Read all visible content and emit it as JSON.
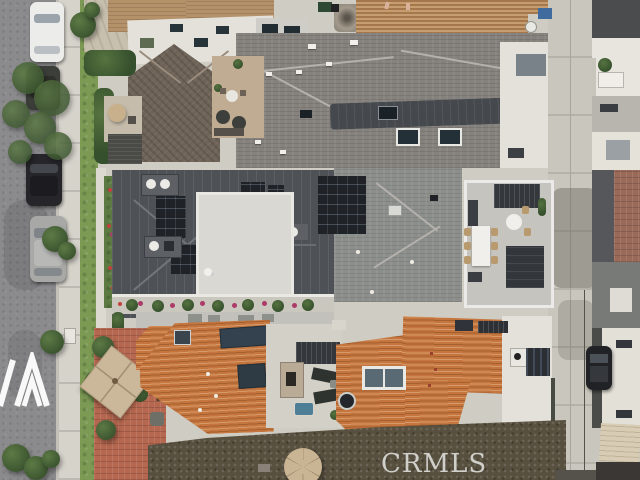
{
  "image": {
    "kind": "aerial drone photograph",
    "subject": "top-down view of a row of coastal homes between a residential street and a rear alley",
    "width_px": 640,
    "height_px": 480
  },
  "watermarks": {
    "crmls": {
      "text": "CRMLS",
      "color": "#dcdcda"
    },
    "agency_logo": {
      "glyph": "double-triangle-mountain-mark",
      "color": "#ffffff"
    }
  },
  "scene": {
    "street": {
      "name": "residential street",
      "asphalt": "#8b8b8d",
      "sidewalk": "#d6d3cb",
      "parkway_grass": "#7c9a54"
    },
    "alley": {
      "name": "rear alley",
      "concrete": "#c9c6bd"
    },
    "vehicles": [
      {
        "name": "white sedan parked on street",
        "color": "#ececea"
      },
      {
        "name": "dark hatchback parked on street",
        "color": "#3c3e3a"
      },
      {
        "name": "black suv parked on street",
        "color": "#26262a"
      },
      {
        "name": "silver suv parked on street",
        "color": "#a8a8a6"
      },
      {
        "name": "dark suv parked in alley",
        "color": "#202226"
      }
    ],
    "homes": [
      {
        "name": "north home",
        "roofs": [
          "tan shingle",
          "white flat roof with skylights",
          "brown slate hip roof",
          "gray composition shingle",
          "multicolor clay tile"
        ],
        "features": [
          "roof deck with furniture",
          "small turret"
        ]
      },
      {
        "name": "middle home",
        "roofs": [
          "charcoal standing-seam metal",
          "white flat center roof",
          "gray shingle east wing"
        ],
        "features": [
          "solar panels",
          "rooftop dining deck",
          "flower boxes in bloom"
        ]
      },
      {
        "name": "south home",
        "roofs": [
          "orange clay tile",
          "white flat east wing"
        ],
        "features": [
          "courtyard deck",
          "outdoor fireplace",
          "spa",
          "dark pergolas",
          "tan patio umbrellas",
          "brick patio with palms"
        ]
      }
    ],
    "palette": {
      "gray_shingle": "#85827d",
      "metal_roof": "#4e5257",
      "clay_tile": "#c4763e",
      "slate_roof": "#6f6458",
      "south_dark_roof": "#58503f",
      "white_roof": "#e4e1da",
      "grass": "#7c9a54",
      "brick_patio": "#b5674f",
      "umbrella_tan": "#cbb79a"
    }
  }
}
